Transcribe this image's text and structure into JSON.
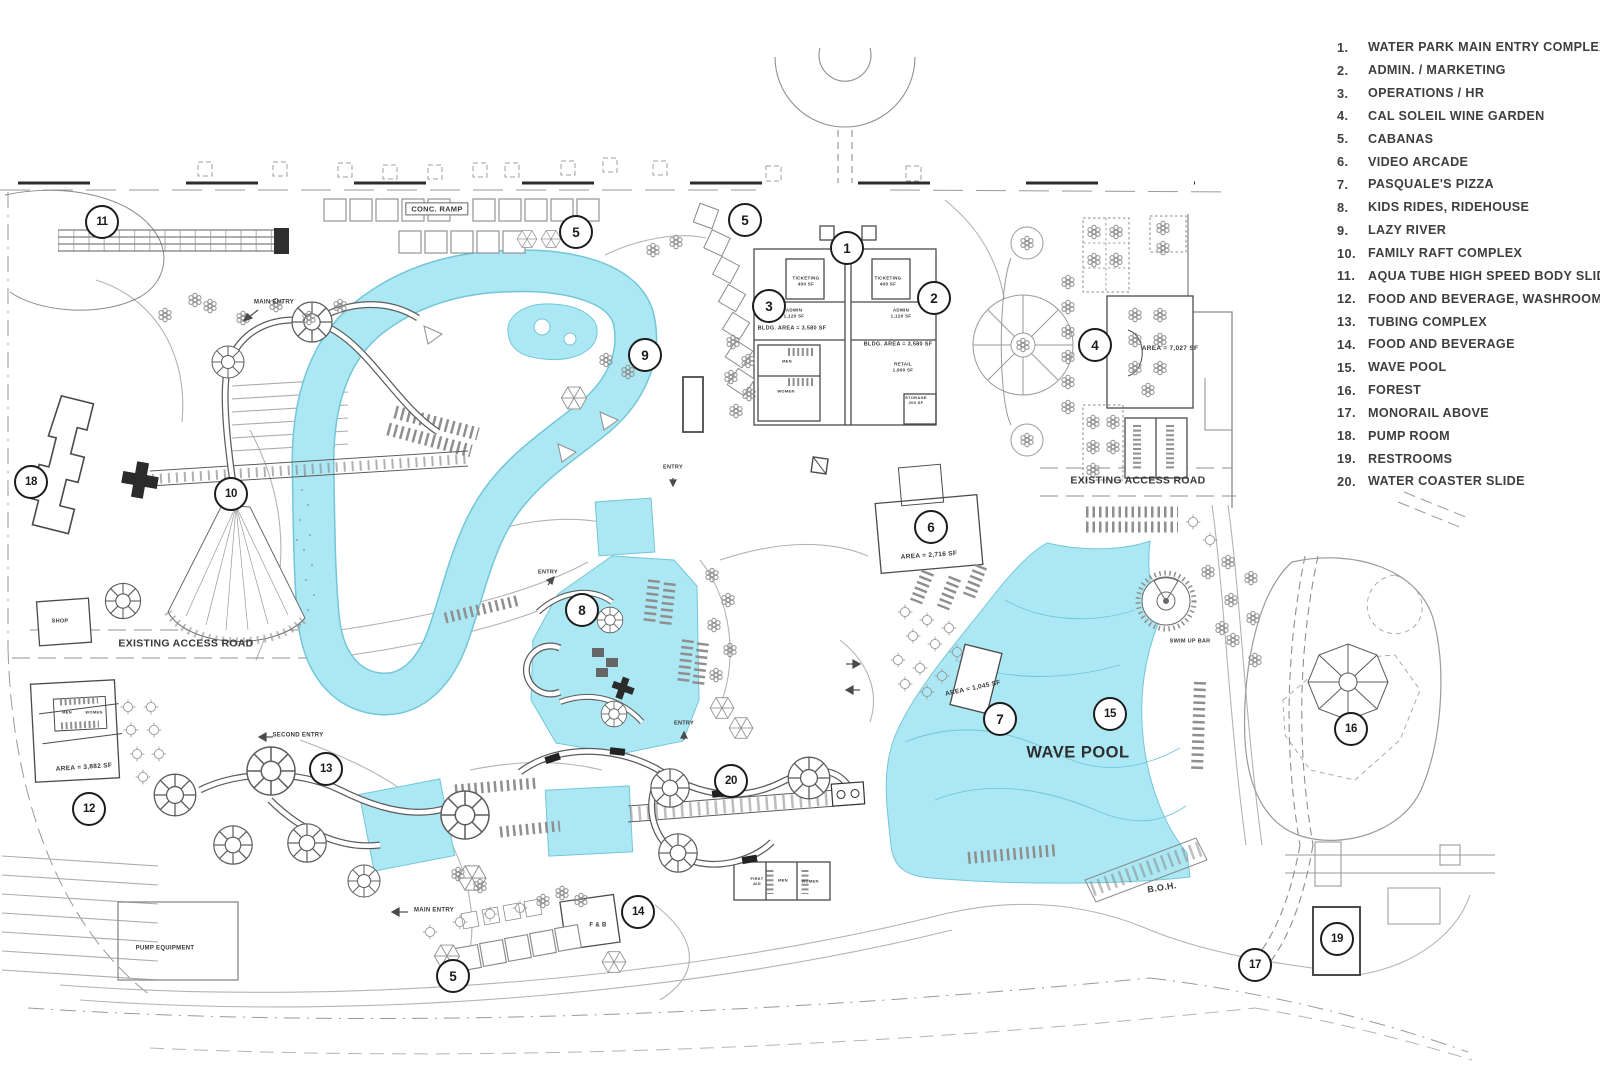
{
  "colors": {
    "water": "#ace8f4",
    "water_edge": "#72c6d8",
    "ink": "#4a4a4a",
    "light_line": "#b3b3b3",
    "legend_text": "#3e3e3e",
    "marker_ring": "#1c1c1c"
  },
  "legend": {
    "items": [
      {
        "num": "1.",
        "label": "WATER PARK MAIN ENTRY COMPLEX"
      },
      {
        "num": "2.",
        "label": "ADMIN. / MARKETING"
      },
      {
        "num": "3.",
        "label": "OPERATIONS / HR"
      },
      {
        "num": "4.",
        "label": "CAL SOLEIL WINE GARDEN"
      },
      {
        "num": "5.",
        "label": "CABANAS"
      },
      {
        "num": "6.",
        "label": "VIDEO ARCADE"
      },
      {
        "num": "7.",
        "label": "PASQUALE'S PIZZA"
      },
      {
        "num": "8.",
        "label": "KIDS RIDES, RIDEHOUSE"
      },
      {
        "num": "9.",
        "label": "LAZY RIVER"
      },
      {
        "num": "10.",
        "label": "FAMILY RAFT COMPLEX"
      },
      {
        "num": "11.",
        "label": "AQUA TUBE HIGH SPEED BODY SLIDE"
      },
      {
        "num": "12.",
        "label": "FOOD AND BEVERAGE, WASHROOMS"
      },
      {
        "num": "13.",
        "label": "TUBING COMPLEX"
      },
      {
        "num": "14.",
        "label": "FOOD AND BEVERAGE"
      },
      {
        "num": "15.",
        "label": "WAVE POOL"
      },
      {
        "num": "16.",
        "label": "FOREST"
      },
      {
        "num": "17.",
        "label": "MONORAIL ABOVE"
      },
      {
        "num": "18.",
        "label": "PUMP ROOM"
      },
      {
        "num": "19.",
        "label": "RESTROOMS"
      },
      {
        "num": "20.",
        "label": "WATER COASTER SLIDE"
      }
    ]
  },
  "markers": [
    {
      "id": "1",
      "n": "1",
      "x": 846,
      "y": 247
    },
    {
      "id": "2",
      "n": "2",
      "x": 933,
      "y": 297
    },
    {
      "id": "3",
      "n": "3",
      "x": 768,
      "y": 305
    },
    {
      "id": "4",
      "n": "4",
      "x": 1094,
      "y": 344
    },
    {
      "id": "5a",
      "n": "5",
      "x": 575,
      "y": 231
    },
    {
      "id": "5b",
      "n": "5",
      "x": 744,
      "y": 219
    },
    {
      "id": "5c",
      "n": "5",
      "x": 452,
      "y": 975
    },
    {
      "id": "6",
      "n": "6",
      "x": 930,
      "y": 526
    },
    {
      "id": "7",
      "n": "7",
      "x": 999,
      "y": 718
    },
    {
      "id": "8",
      "n": "8",
      "x": 581,
      "y": 609
    },
    {
      "id": "9",
      "n": "9",
      "x": 644,
      "y": 354
    },
    {
      "id": "10",
      "n": "10",
      "x": 230,
      "y": 493
    },
    {
      "id": "11",
      "n": "11",
      "x": 101,
      "y": 221
    },
    {
      "id": "12",
      "n": "12",
      "x": 88,
      "y": 808
    },
    {
      "id": "13",
      "n": "13",
      "x": 325,
      "y": 768
    },
    {
      "id": "14",
      "n": "14",
      "x": 637,
      "y": 911
    },
    {
      "id": "15",
      "n": "15",
      "x": 1109,
      "y": 713
    },
    {
      "id": "16",
      "n": "16",
      "x": 1350,
      "y": 728
    },
    {
      "id": "17",
      "n": "17",
      "x": 1254,
      "y": 964
    },
    {
      "id": "18",
      "n": "18",
      "x": 30,
      "y": 481
    },
    {
      "id": "19",
      "n": "19",
      "x": 1336,
      "y": 938
    },
    {
      "id": "20",
      "n": "20",
      "x": 730,
      "y": 780
    }
  ],
  "plan_labels": [
    {
      "name": "conc-ramp-label",
      "text": "CONC. RAMP",
      "x": 437,
      "y": 209,
      "size": 7.5,
      "bold": false,
      "boxed": true
    },
    {
      "name": "existing-access-road-west",
      "text": "EXISTING ACCESS ROAD",
      "x": 186,
      "y": 644,
      "size": 10.5,
      "bold": true
    },
    {
      "name": "existing-access-road-east",
      "text": "EXISTING ACCESS ROAD",
      "x": 1138,
      "y": 481,
      "size": 10.5,
      "bold": true
    },
    {
      "name": "wave-pool-label",
      "text": "WAVE POOL",
      "x": 1078,
      "y": 753,
      "size": 16.5,
      "bold": true,
      "big": true
    },
    {
      "name": "boh-label",
      "text": "B.O.H.",
      "x": 1162,
      "y": 888,
      "size": 9,
      "bold": true,
      "rotate": -9
    },
    {
      "name": "swim-up-bar-label",
      "text": "SWIM UP BAR",
      "x": 1190,
      "y": 642,
      "size": 5.5
    },
    {
      "name": "pump-equipment-label",
      "text": "PUMP EQUIPMENT",
      "x": 165,
      "y": 949,
      "size": 6
    },
    {
      "name": "f-and-b-label",
      "text": "F & B",
      "x": 598,
      "y": 926,
      "size": 6,
      "bold": true
    },
    {
      "name": "shop-label",
      "text": "SHOP",
      "x": 60,
      "y": 622,
      "size": 5.5
    },
    {
      "name": "main-entry-label-north",
      "text": "MAIN ENTRY",
      "x": 274,
      "y": 303,
      "size": 6,
      "bold": true
    },
    {
      "name": "main-entry-label-south",
      "text": "MAIN ENTRY",
      "x": 434,
      "y": 911,
      "size": 6,
      "bold": true
    },
    {
      "name": "second-entry-label",
      "text": "SECOND ENTRY",
      "x": 298,
      "y": 736,
      "size": 6,
      "bold": true
    },
    {
      "name": "entry-label-1",
      "text": "ENTRY",
      "x": 548,
      "y": 573,
      "size": 5.5
    },
    {
      "name": "entry-label-2",
      "text": "ENTRY",
      "x": 684,
      "y": 724,
      "size": 5.5
    },
    {
      "name": "entry-label-3",
      "text": "ENTRY",
      "x": 673,
      "y": 468,
      "size": 5.5
    },
    {
      "name": "ticketing-label-west",
      "text": "TICKETING\n400 SF",
      "x": 806,
      "y": 281,
      "size": 4.5
    },
    {
      "name": "ticketing-label-east",
      "text": "TICKETING\n400 SF",
      "x": 888,
      "y": 281,
      "size": 4.5
    },
    {
      "name": "admin-label-west",
      "text": "ADMIN\n1,120 SF",
      "x": 794,
      "y": 313,
      "size": 4.5
    },
    {
      "name": "admin-label-east",
      "text": "ADMIN\n1,120 SF",
      "x": 901,
      "y": 313,
      "size": 4.5
    },
    {
      "name": "bldg-area-label-west",
      "text": "BLDG. AREA = 3,580 SF",
      "x": 792,
      "y": 329,
      "size": 5.5
    },
    {
      "name": "bldg-area-label-east",
      "text": "BLDG. AREA = 3,580 SF",
      "x": 898,
      "y": 345,
      "size": 5.5
    },
    {
      "name": "retail-label",
      "text": "RETAIL\n1,900 SF",
      "x": 903,
      "y": 367,
      "size": 4.5
    },
    {
      "name": "storage-label",
      "text": "STORAGE\n200 SF",
      "x": 916,
      "y": 400,
      "size": 4
    },
    {
      "name": "men-label-entry",
      "text": "MEN",
      "x": 787,
      "y": 361,
      "size": 4
    },
    {
      "name": "women-label-entry",
      "text": "WOMEN",
      "x": 786,
      "y": 391,
      "size": 4
    },
    {
      "name": "arcade-area-label",
      "text": "AREA = 2,716 SF",
      "x": 929,
      "y": 556,
      "size": 6.5,
      "rotate": -4
    },
    {
      "name": "pizza-area-label",
      "text": "AREA = 1,045 SF",
      "x": 973,
      "y": 689,
      "size": 6.5,
      "rotate": -12
    },
    {
      "name": "wine-garden-area-label",
      "text": "AREA = 7,027 SF",
      "x": 1170,
      "y": 349,
      "size": 6.5
    },
    {
      "name": "west-fb-area-label",
      "text": "AREA = 3,882 SF",
      "x": 84,
      "y": 768,
      "size": 6.5,
      "rotate": -4
    },
    {
      "name": "first-aid-label",
      "text": "FIRST\nAID",
      "x": 757,
      "y": 881,
      "size": 4
    },
    {
      "name": "men-label-south",
      "text": "MEN",
      "x": 783,
      "y": 880,
      "size": 4
    },
    {
      "name": "women-label-south",
      "text": "WOMEN",
      "x": 810,
      "y": 881,
      "size": 4
    },
    {
      "name": "men-label-west",
      "text": "MEN",
      "x": 67,
      "y": 712,
      "size": 4
    },
    {
      "name": "women-label-west",
      "text": "WOMEN",
      "x": 94,
      "y": 712,
      "size": 4
    }
  ]
}
